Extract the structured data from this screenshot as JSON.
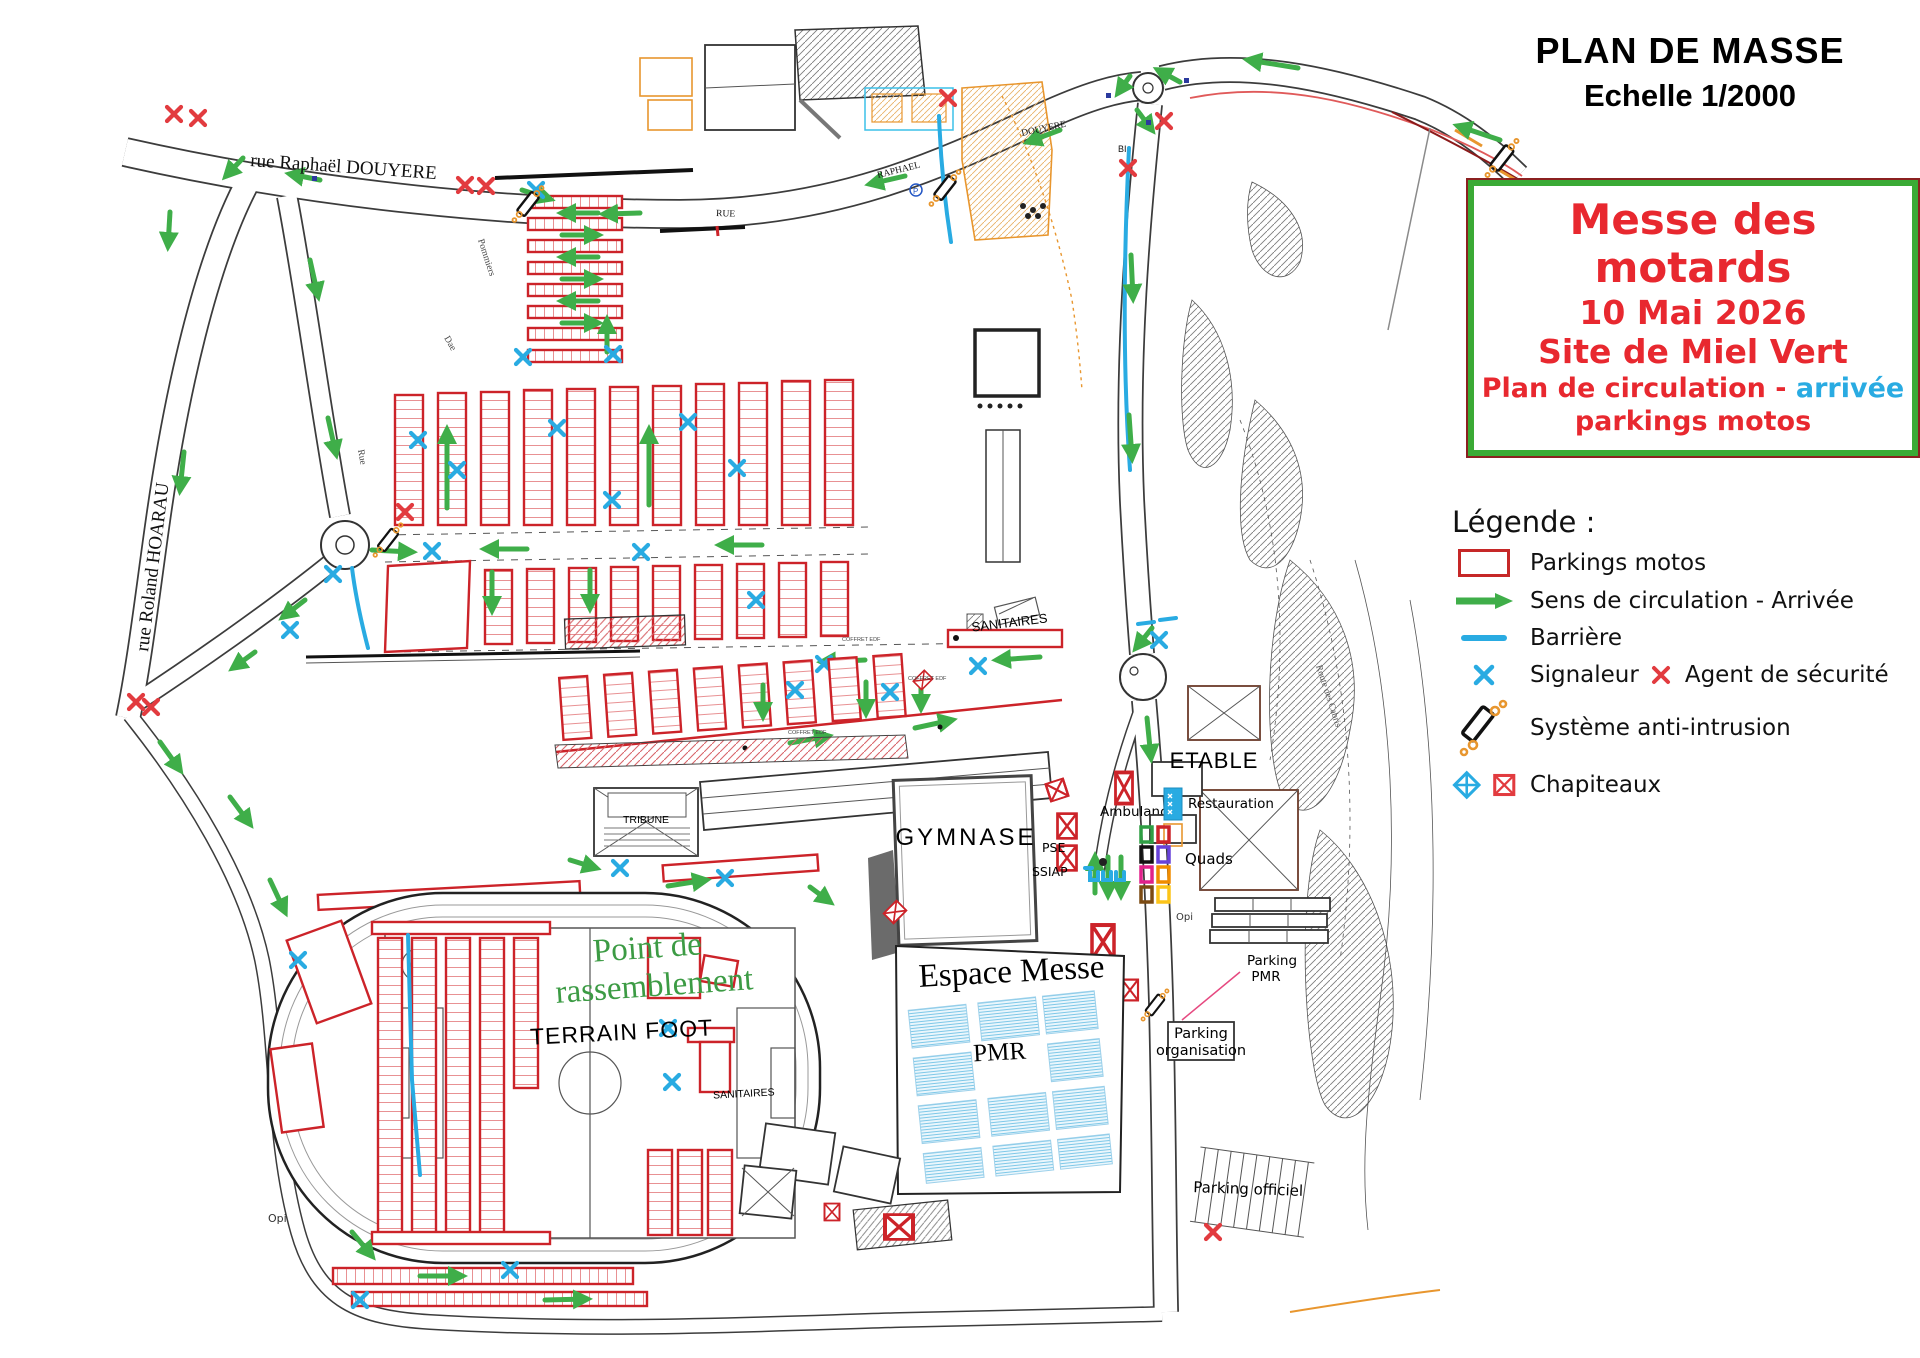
{
  "title": {
    "line1": "PLAN DE MASSE",
    "line2": "Echelle 1/2000"
  },
  "info_box": {
    "title": "Messe des motards",
    "date": "10 Mai 2026",
    "site": "Site de Miel Vert",
    "line4_prefix": "Plan de circulation - ",
    "line4_highlight": "arrivée",
    "line5": "parkings motos"
  },
  "legend": {
    "heading": "Légende :",
    "parkings": "Parkings motos",
    "sens": "Sens de circulation - Arrivée",
    "barriere": "Barrière",
    "signaleur": "Signaleur",
    "agent": "Agent de sécurité",
    "anti_intrusion": "Système anti-intrusion",
    "chapiteaux": "Chapiteaux"
  },
  "map": {
    "streets": {
      "douyere": "rue Raphaël DOUYERE",
      "hoarau": "rue Roland HOARAU",
      "rue_small": "RUE",
      "raphael_small": "RAPHAEL",
      "douyere_small": "DOUYERE",
      "pommiers": "Pommiers",
      "dae": "Dae",
      "rue_tiny": "Rue",
      "cabris": "Route des Cabris",
      "bi": "BI",
      "p": "P"
    },
    "areas": {
      "gymnase": "GYMNASE",
      "espace_messe": "Espace Messe",
      "pmr": "PMR",
      "etable": "ETABLE",
      "terrain_foot": "TERRAIN FOOT",
      "point_rassemblement_1": "Point de",
      "point_rassemblement_2": "rassemblement",
      "tribune": "TRIBUNE",
      "sanitaires_nord": "SANITAIRES",
      "sanitaires_sud": "SANITAIRES"
    },
    "services": {
      "ambulance": "Ambulance",
      "pse": "PSE",
      "ssiap": "SSIAP",
      "restauration": "Restauration",
      "quads": "Quads",
      "parking_pmr_1": "Parking",
      "parking_pmr_2": "PMR",
      "parking_org_1": "Parking",
      "parking_org_2": "organisation",
      "parking_officiel": "Parking officiel",
      "opi_1": "Opi",
      "opi_2": "Opi",
      "coffret_edf": "COFFRET EDF"
    }
  },
  "colors": {
    "parking_red": "#cc2329",
    "arrow_green": "#3fae49",
    "barrier_cyan": "#29abe2",
    "agent_red": "#e23b3f",
    "info_red": "#e8282f",
    "box_green": "#3aaa35",
    "rassemblement_green": "#3c9b44",
    "orange": "#e8962e"
  }
}
